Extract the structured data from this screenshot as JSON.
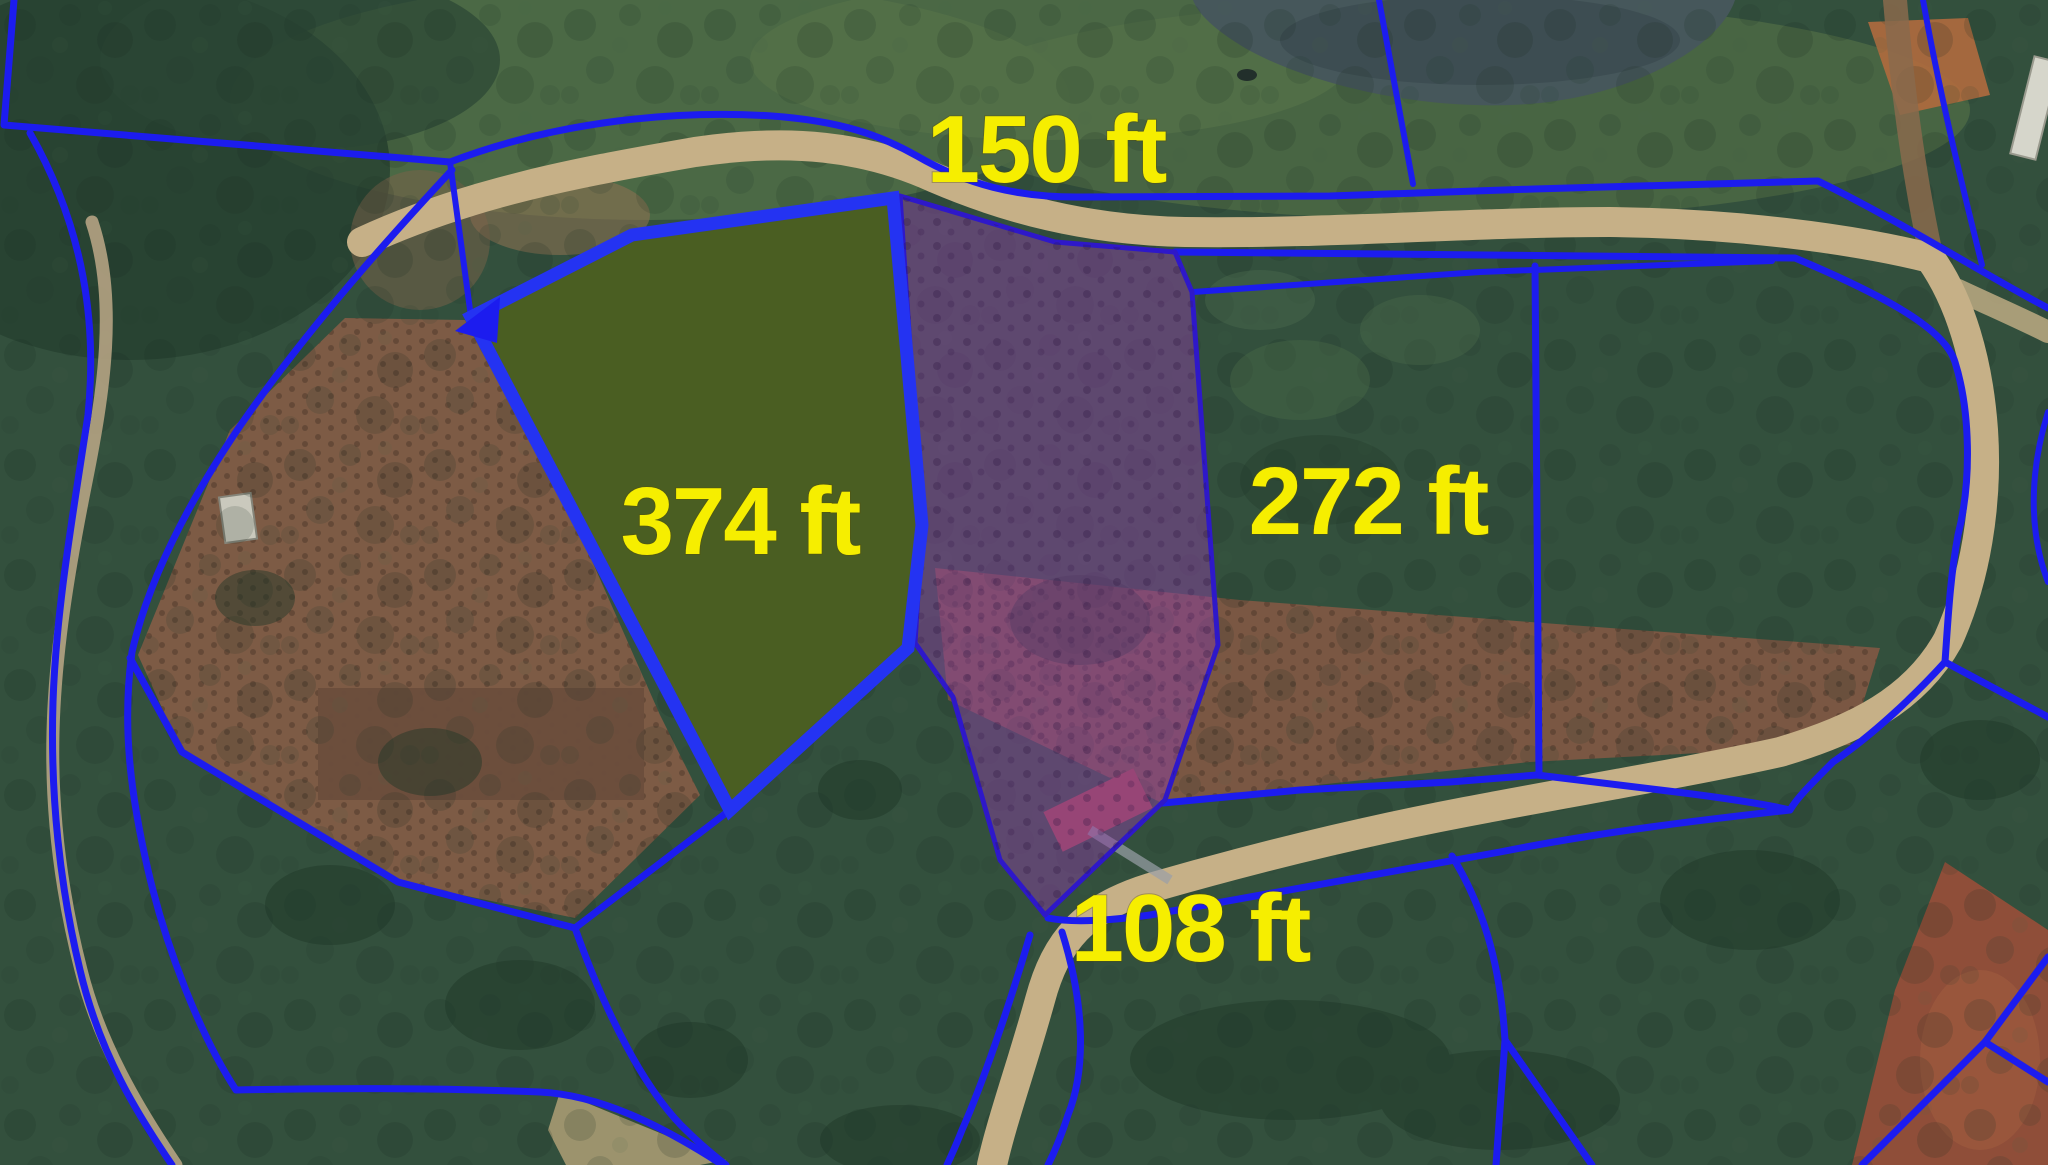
{
  "map": {
    "kind": "satellite-parcel-map",
    "measurements": {
      "north": {
        "text": "150 ft"
      },
      "west": {
        "text": "374 ft"
      },
      "east": {
        "text": "272 ft"
      },
      "south": {
        "text": "108 ft"
      }
    },
    "parcels": {
      "green": {
        "fill": "#4a5e22",
        "stroke": "#2433f2"
      },
      "purple": {
        "fill": "#8a3fa2",
        "stroke": "#2e18c9"
      }
    },
    "colors": {
      "boundary_blue": "#1c1cef",
      "label_yellow": "#f6ee00",
      "road_tan": "#c6b087",
      "forest_green": "#33503d",
      "farmland_brown": "#7d5b45",
      "water": "#46575b"
    }
  }
}
